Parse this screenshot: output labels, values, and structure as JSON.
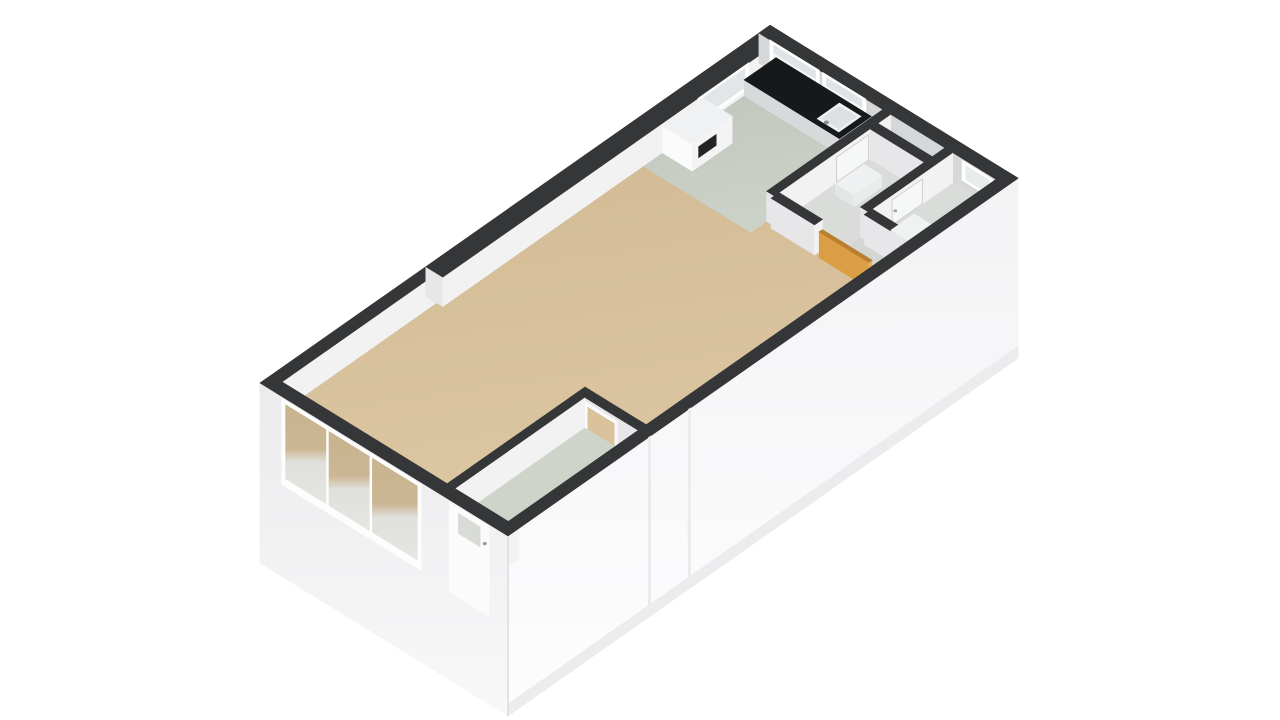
{
  "view": {
    "name": "3d-floorplan-render",
    "description_not_rendered": "",
    "width": 1280,
    "height": 720,
    "background": "#ffffff"
  },
  "projection": {
    "origin": [
      260,
      413
    ],
    "ex": [
      0.797,
      -0.559
    ],
    "ey": [
      0.775,
      0.478
    ],
    "wall_top": 30,
    "facade_drop": 150
  },
  "palette": {
    "wall_band": "#353638",
    "wall_face_south": "#f2f2f3",
    "wall_face_west": "#e7e7e9",
    "ne_wall_face": "#d5d7d8",
    "counter_top": "#17181a",
    "appliance_panel": "#232426",
    "door_orange": "#dc9e44",
    "door_orange_light": "#e6b066",
    "door_orange_dark": "#b97f30",
    "floor_living": "#d7c09b",
    "floor_kitchen": "#c5cac2",
    "floor_bedroom": "#cfd4cb",
    "floor_hall": "#d3d6d2",
    "floor_bathroom": "#d9dcd8",
    "floor_toilet": "#dadcd9",
    "glass": "#dfe4e6"
  },
  "gradients": [
    {
      "id": "gTan",
      "x2": 0.25,
      "y2": 1,
      "stops": [
        [
          0,
          "#d1ba93"
        ],
        [
          1,
          "#ddc7a3"
        ]
      ]
    },
    {
      "id": "gKit",
      "x2": 0.25,
      "y2": 1,
      "stops": [
        [
          0,
          "#bfc5bc"
        ],
        [
          1,
          "#cdd2c9"
        ]
      ]
    },
    {
      "id": "gSE",
      "x2": 0,
      "y2": 1,
      "stops": [
        [
          0,
          "#f3f3f5"
        ],
        [
          1,
          "#fdfdfe"
        ]
      ]
    },
    {
      "id": "gSW",
      "x2": 0,
      "y2": 1,
      "stops": [
        [
          0,
          "#ebebed"
        ],
        [
          1,
          "#f8f8f9"
        ]
      ]
    },
    {
      "id": "gGlass",
      "x2": 0,
      "y2": 1,
      "stops": [
        [
          0,
          "#c7b38e"
        ],
        [
          0.45,
          "#ccb794"
        ],
        [
          0.58,
          "#dfe0db"
        ],
        [
          1,
          "#e5e6e2"
        ]
      ]
    }
  ],
  "items": [
    {
      "type": "wall",
      "name": "wall-nw-left",
      "rect": [
        0,
        0,
        208,
        14
      ]
    },
    {
      "type": "wall",
      "name": "wall-nw-right",
      "rect": [
        208,
        0,
        640,
        22
      ]
    },
    {
      "type": "panel",
      "name": "kitchen-window-nw-frame",
      "plane": "y",
      "at": 22,
      "u0": 528,
      "u1": 592,
      "h0": 4,
      "h1": 30,
      "fill": "#ffffff"
    },
    {
      "type": "panel",
      "name": "kitchen-window-nw-glass",
      "plane": "y",
      "at": 22,
      "u0": 533,
      "u1": 587,
      "h0": 8,
      "h1": 27,
      "fill": "#e2e6e8"
    },
    {
      "type": "wall",
      "name": "wall-ne",
      "rect": [
        626,
        0,
        640,
        320
      ],
      "fw": "#d5d7d8"
    },
    {
      "type": "panel",
      "name": "kitchen-window-ne1-frame",
      "plane": "x",
      "at": 626,
      "u0": 14,
      "u1": 78,
      "h0": 2,
      "h1": 30,
      "fill": "#ffffff"
    },
    {
      "type": "panel",
      "name": "kitchen-window-ne1-glass",
      "plane": "x",
      "at": 626,
      "u0": 19,
      "u1": 73,
      "h0": 6,
      "h1": 27,
      "fill": "#dfe4e6"
    },
    {
      "type": "panel",
      "name": "kitchen-window-ne1-mullion",
      "plane": "x",
      "at": 626,
      "u0": 19,
      "u1": 73,
      "h0": 16,
      "h1": 18.5,
      "fill": "#f6f8f8"
    },
    {
      "type": "panel",
      "name": "kitchen-window-ne2-frame",
      "plane": "x",
      "at": 626,
      "u0": 82,
      "u1": 138,
      "h0": 2,
      "h1": 30,
      "fill": "#ffffff"
    },
    {
      "type": "panel",
      "name": "kitchen-window-ne2-glass",
      "plane": "x",
      "at": 626,
      "u0": 87,
      "u1": 133,
      "h0": 6,
      "h1": 27,
      "fill": "#dfe4e6"
    },
    {
      "type": "panel",
      "name": "kitchen-window-ne2-mullion",
      "plane": "x",
      "at": 626,
      "u0": 87,
      "u1": 133,
      "h0": 16,
      "h1": 18.5,
      "fill": "#f6f8f8"
    },
    {
      "type": "panel",
      "name": "toilet-window-frame",
      "plane": "x",
      "at": 626,
      "u0": 262,
      "u1": 302,
      "h0": 8,
      "h1": 28,
      "fill": "#ffffff"
    },
    {
      "type": "panel",
      "name": "toilet-window-glass",
      "plane": "x",
      "at": 626,
      "u0": 267,
      "u1": 297,
      "h0": 11,
      "h1": 25,
      "fill": "#e9ecec"
    },
    {
      "type": "floor",
      "name": "living-room-floor",
      "pts": [
        [
          14,
          14
        ],
        [
          208,
          14
        ],
        [
          208,
          22
        ],
        [
          460,
          22
        ],
        [
          460,
          160
        ],
        [
          480,
          160
        ],
        [
          480,
          306
        ],
        [
          187,
          306
        ],
        [
          187,
          227
        ],
        [
          14,
          227
        ]
      ],
      "fill": "url(#gTan)"
    },
    {
      "type": "floor",
      "name": "kitchen-floor",
      "pts": [
        [
          460,
          22
        ],
        [
          626,
          22
        ],
        [
          626,
          160
        ],
        [
          460,
          160
        ]
      ],
      "fill": "url(#gKit)"
    },
    {
      "type": "floor",
      "name": "hallway-floor",
      "pts": [
        [
          480,
          160
        ],
        [
          626,
          160
        ],
        [
          626,
          306
        ],
        [
          480,
          306
        ]
      ],
      "fill": "#d3d6d2"
    },
    {
      "type": "floor",
      "name": "bathroom-floor",
      "pts": [
        [
          486,
          170
        ],
        [
          600,
          170
        ],
        [
          600,
          240
        ],
        [
          486,
          240
        ]
      ],
      "fill": "#d9dcd8"
    },
    {
      "type": "floor",
      "name": "toilet-floor",
      "pts": [
        [
          525,
          250
        ],
        [
          626,
          250
        ],
        [
          626,
          306
        ],
        [
          525,
          306
        ]
      ],
      "fill": "#dadcd9"
    },
    {
      "type": "floor",
      "name": "bedroom-floor",
      "pts": [
        [
          14,
          237
        ],
        [
          177,
          237
        ],
        [
          177,
          306
        ],
        [
          14,
          306
        ]
      ],
      "fill": "#cfd4cb"
    },
    {
      "type": "box",
      "name": "kitchen-counter",
      "rect": [
        586,
        22,
        626,
        145
      ],
      "t": 16,
      "top": "#17181a",
      "fw": "#d8d9da",
      "fs": "#e4e5e6"
    },
    {
      "type": "panel",
      "name": "kitchen-sink",
      "plane": "top",
      "at": 16,
      "u0": 592,
      "u1": 620,
      "v0": 110,
      "v1": 138,
      "fill": "#eef1f1"
    },
    {
      "type": "panel",
      "name": "kitchen-sink-basin",
      "plane": "top",
      "at": 16,
      "u0": 595,
      "u1": 617,
      "v0": 113,
      "v1": 135,
      "fill": "#dde1e1"
    },
    {
      "type": "dot",
      "name": "kitchen-faucet",
      "x": 590,
      "y": 124,
      "h": 20,
      "r": 2.5,
      "fill": "#8e9092"
    },
    {
      "type": "box",
      "name": "tall-cabinet",
      "rect": [
        484,
        22,
        534,
        60
      ],
      "t": 27,
      "top": "#f0f1f2",
      "fw": "#fbfbfc",
      "fs": "#f4f4f5"
    },
    {
      "type": "panel",
      "name": "cabinet-appliance-panel",
      "plane": "y",
      "at": 60,
      "u0": 492,
      "u1": 514,
      "h0": 9,
      "h1": 20,
      "fill": "#232426"
    },
    {
      "type": "box",
      "name": "bathroom-sink",
      "rect": [
        545,
        182,
        580,
        206
      ],
      "t": 12,
      "top": "#eef0f1",
      "fw": "#e3e5e6",
      "fs": "#eaecec"
    },
    {
      "type": "wall",
      "name": "wall-kitchen-bathroom",
      "rect": [
        480,
        160,
        626,
        170
      ]
    },
    {
      "type": "panel",
      "name": "bathroom-door",
      "plane": "y",
      "at": 170,
      "u0": 558,
      "u1": 598,
      "h0": 0,
      "h1": 25,
      "fill": "#f6f7f7",
      "stroke": "#d0d0d3"
    },
    {
      "type": "wall",
      "name": "wall-bathroom-shaft",
      "rect": [
        600,
        170,
        610,
        240
      ]
    },
    {
      "type": "wall",
      "name": "wall-toilet-north",
      "rect": [
        520,
        240,
        626,
        250
      ]
    },
    {
      "type": "panel",
      "name": "toilet-door",
      "plane": "y",
      "at": 250,
      "u0": 550,
      "u1": 588,
      "h0": 0,
      "h1": 25,
      "fill": "#f6f7f7",
      "stroke": "#d0d0d3"
    },
    {
      "type": "dot",
      "name": "toilet-door-handle",
      "x": 554,
      "y": 250,
      "h": 12,
      "r": 1.8,
      "fill": "#a0a2a4"
    },
    {
      "type": "wall",
      "name": "wall-toilet-west",
      "rect": [
        515,
        250,
        525,
        306
      ]
    },
    {
      "type": "box",
      "name": "toilet-wc",
      "rect": [
        535,
        264,
        564,
        294
      ],
      "t": 10,
      "top": "#f0f2f2",
      "fw": "#e5e7e8",
      "fs": "#ebeded"
    },
    {
      "type": "wall",
      "name": "wall-hall-living",
      "rect": [
        476,
        170,
        486,
        226
      ]
    },
    {
      "type": "box",
      "name": "entrance-door-open",
      "rect": [
        476,
        232,
        480,
        296
      ],
      "t": 26,
      "top": "#b97f30",
      "fw": "#dc9e44",
      "fs": "#e6b066"
    },
    {
      "type": "wall",
      "name": "bedroom-wall-east",
      "rect": [
        177,
        227,
        187,
        306
      ]
    },
    {
      "type": "panel",
      "name": "bedroom-doorway-frame",
      "plane": "x",
      "at": 177,
      "u0": 237,
      "u1": 279,
      "h0": 0,
      "h1": 26,
      "fill": "#fafafa"
    },
    {
      "type": "panel",
      "name": "bedroom-doorway-open",
      "plane": "x",
      "at": 177,
      "u0": 241,
      "u1": 275,
      "h0": 0,
      "h1": 22,
      "fill": "#d9c29c"
    },
    {
      "type": "wall",
      "name": "bedroom-wall-north",
      "rect": [
        14,
        227,
        177,
        237
      ]
    },
    {
      "type": "wall",
      "name": "wall-se-facade",
      "rect": [
        0,
        306,
        640,
        320
      ],
      "drop": 150,
      "outer": "s",
      "fo": "url(#gSE)"
    },
    {
      "type": "panel",
      "name": "facade-seam-1",
      "plane": "y",
      "at": 320,
      "u0": 176,
      "u1": 179,
      "h0": 30,
      "h1": -150,
      "fill": "#ebebed"
    },
    {
      "type": "panel",
      "name": "facade-seam-2",
      "plane": "y",
      "at": 320,
      "u0": 226,
      "u1": 229,
      "h0": 30,
      "h1": -150,
      "fill": "#ebebed"
    },
    {
      "type": "panel",
      "name": "facade-se-base",
      "plane": "y",
      "at": 320,
      "u0": 0,
      "u1": 640,
      "h0": -138,
      "h1": -150,
      "fill": "#ececee"
    },
    {
      "type": "wall",
      "name": "wall-sw-facade",
      "rect": [
        0,
        0,
        14,
        320
      ],
      "drop": 150,
      "outer": "w",
      "fo": "url(#gSW)"
    },
    {
      "type": "panel",
      "name": "balcony-glazing-frame",
      "plane": "x",
      "at": 0,
      "u0": 28,
      "u1": 208,
      "h0": 28,
      "h1": -58,
      "fill": "#fdfdfd"
    },
    {
      "type": "panel",
      "name": "balcony-glazing-pane-1",
      "plane": "x",
      "at": 0,
      "u0": 33,
      "u1": 85,
      "h0": 24,
      "h1": -50,
      "fill": "url(#gGlass)"
    },
    {
      "type": "panel",
      "name": "balcony-glazing-pane-2",
      "plane": "x",
      "at": 0,
      "u0": 89,
      "u1": 141,
      "h0": 24,
      "h1": -50,
      "fill": "url(#gGlass)"
    },
    {
      "type": "panel",
      "name": "balcony-glazing-pane-3",
      "plane": "x",
      "at": 0,
      "u0": 145,
      "u1": 203,
      "h0": 24,
      "h1": -50,
      "fill": "url(#gGlass)"
    },
    {
      "type": "panel",
      "name": "bedroom-exterior-door",
      "plane": "x",
      "at": 0,
      "u0": 244,
      "u1": 296,
      "h0": 28,
      "h1": -62,
      "fill": "#fbfbfc"
    },
    {
      "type": "panel",
      "name": "bedroom-exterior-door-glass",
      "plane": "x",
      "at": 0,
      "u0": 256,
      "u1": 284,
      "h0": 22,
      "h1": 2,
      "fill": "#d9dbd6"
    },
    {
      "type": "dot",
      "name": "bedroom-exterior-door-handle",
      "x": 0,
      "y": 290,
      "h": 8,
      "r": 2,
      "fill": "#97999b"
    },
    {
      "type": "edge",
      "name": "facade-corner-edge",
      "from": [
        0,
        320,
        30
      ],
      "to": [
        0,
        320,
        -150
      ],
      "color": "#dcdcdf",
      "w": 1.5
    }
  ]
}
